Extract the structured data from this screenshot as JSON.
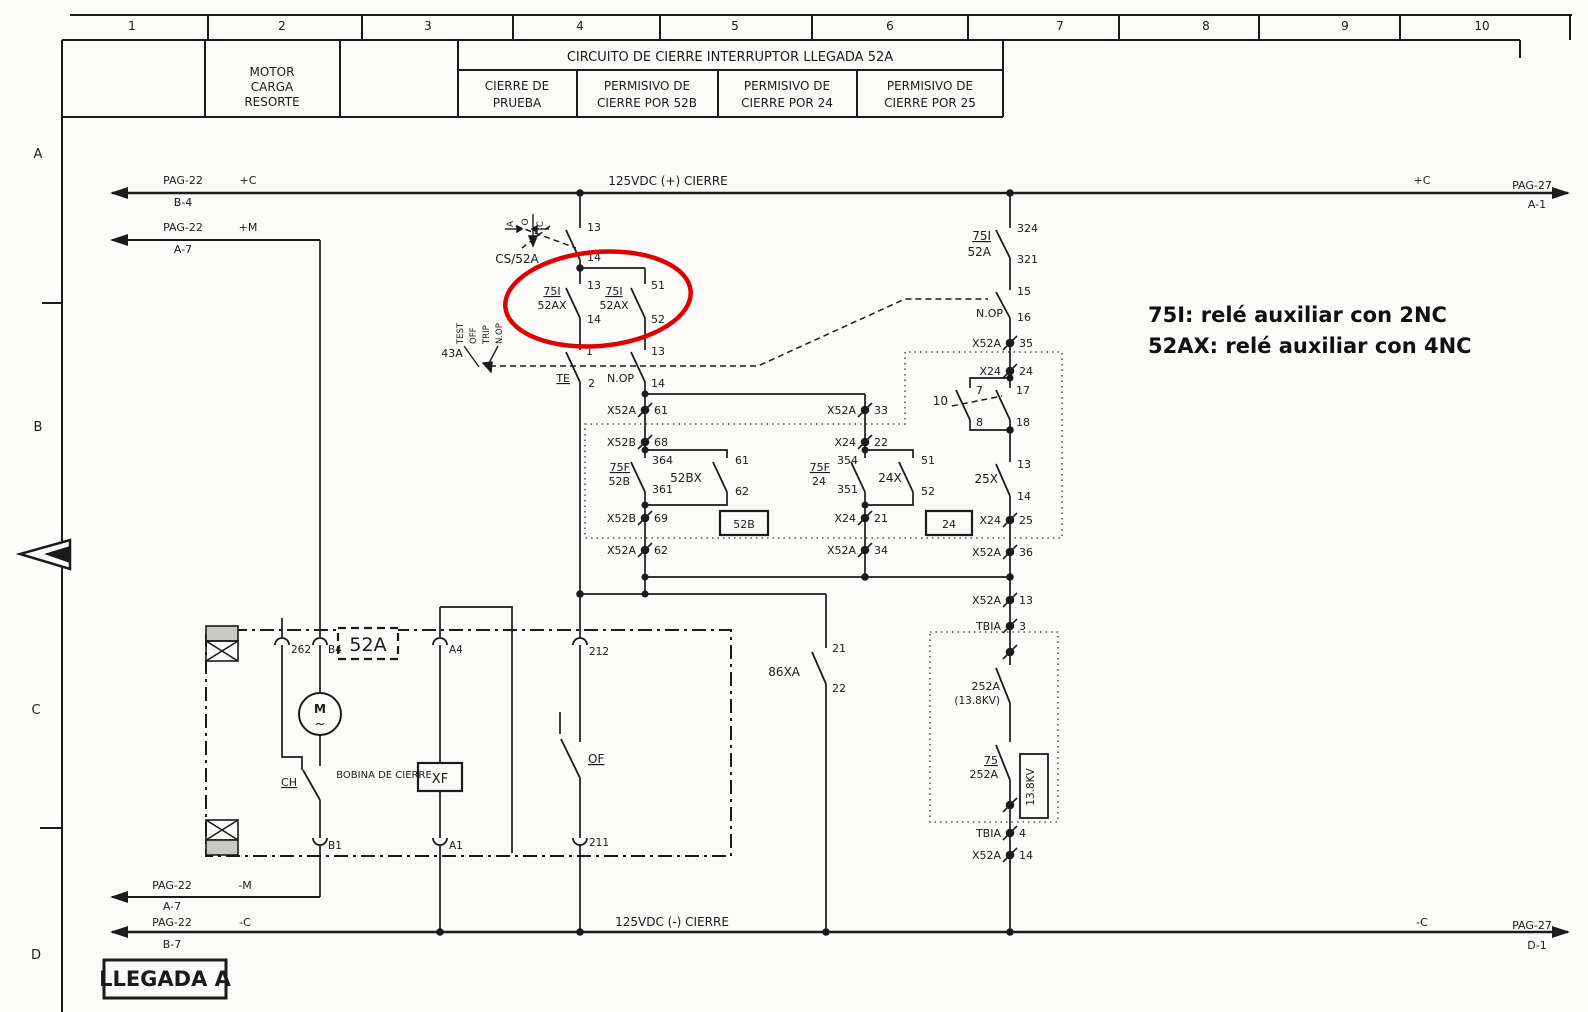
{
  "page": {
    "bg": "#fbfbf9",
    "ink": "#1b1b1b",
    "highlight_red": "#e10000"
  },
  "meta": {
    "drawing_title": "CIRCUITO DE CIERRE INTERRUPTOR LLEGADA 52A",
    "sheet_label": "LLEGADA A",
    "bus_positive": "125VDC (+) CIERRE",
    "bus_negative": "125VDC (-) CIERRE"
  },
  "annotation": {
    "line1": "75I: relé auxiliar con 2NC",
    "line2": "52AX: relé auxiliar con 4NC"
  },
  "terminals": [
    {
      "x": 645,
      "y": 410,
      "p": "X52A",
      "pin": "61"
    },
    {
      "x": 645,
      "y": 442,
      "p": "X52B",
      "pin": "68"
    },
    {
      "x": 645,
      "y": 518,
      "p": "X52B",
      "pin": "69"
    },
    {
      "x": 645,
      "y": 550,
      "p": "X52A",
      "pin": "62"
    },
    {
      "x": 865,
      "y": 410,
      "p": "X52A",
      "pin": "33"
    },
    {
      "x": 865,
      "y": 442,
      "p": "X24",
      "pin": "22"
    },
    {
      "x": 865,
      "y": 518,
      "p": "X24",
      "pin": "21"
    },
    {
      "x": 865,
      "y": 550,
      "p": "X52A",
      "pin": "34"
    },
    {
      "x": 1010,
      "y": 343,
      "p": "X52A",
      "pin": "35"
    },
    {
      "x": 1010,
      "y": 371,
      "p": "X24",
      "pin": "24"
    },
    {
      "x": 1010,
      "y": 520,
      "p": "X24",
      "pin": "25"
    },
    {
      "x": 1010,
      "y": 552,
      "p": "X52A",
      "pin": "36"
    },
    {
      "x": 1010,
      "y": 600,
      "p": "X52A",
      "pin": "13"
    },
    {
      "x": 1010,
      "y": 626,
      "p": "TBIA",
      "pin": "3"
    },
    {
      "x": 1010,
      "y": 652,
      "p": "",
      "pin": ""
    },
    {
      "x": 1010,
      "y": 805,
      "p": "",
      "pin": ""
    },
    {
      "x": 1010,
      "y": 833,
      "p": "TBIA",
      "pin": "4"
    },
    {
      "x": 1010,
      "y": 855,
      "p": "X52A",
      "pin": "14"
    }
  ],
  "labels": [
    {
      "n": "grid-col-1",
      "t": "1",
      "x": 132,
      "y": 30,
      "s": 12,
      "a": "m"
    },
    {
      "n": "grid-col-2",
      "t": "2",
      "x": 282,
      "y": 30,
      "s": 12,
      "a": "m"
    },
    {
      "n": "grid-col-3",
      "t": "3",
      "x": 428,
      "y": 30,
      "s": 12,
      "a": "m"
    },
    {
      "n": "grid-col-4",
      "t": "4",
      "x": 580,
      "y": 30,
      "s": 12,
      "a": "m"
    },
    {
      "n": "grid-col-5",
      "t": "5",
      "x": 735,
      "y": 30,
      "s": 12,
      "a": "m"
    },
    {
      "n": "grid-col-6",
      "t": "6",
      "x": 890,
      "y": 30,
      "s": 12,
      "a": "m"
    },
    {
      "n": "grid-col-7",
      "t": "7",
      "x": 1060,
      "y": 30,
      "s": 12,
      "a": "m"
    },
    {
      "n": "grid-col-8",
      "t": "8",
      "x": 1206,
      "y": 30,
      "s": 12,
      "a": "m"
    },
    {
      "n": "grid-col-9",
      "t": "9",
      "x": 1345,
      "y": 30,
      "s": 12,
      "a": "m"
    },
    {
      "n": "grid-col-10",
      "t": "10",
      "x": 1482,
      "y": 30,
      "s": 12,
      "a": "m"
    },
    {
      "n": "grid-row-a",
      "t": "A",
      "x": 38,
      "y": 158,
      "s": 13,
      "a": "m"
    },
    {
      "n": "grid-row-b",
      "t": "B",
      "x": 38,
      "y": 431,
      "s": 13,
      "a": "m"
    },
    {
      "n": "grid-row-c",
      "t": "C",
      "x": 36,
      "y": 714,
      "s": 13,
      "a": "m"
    },
    {
      "n": "grid-row-d",
      "t": "D",
      "x": 36,
      "y": 959,
      "s": 13,
      "a": "m"
    },
    {
      "n": "cell-motor-1",
      "t": "MOTOR",
      "x": 272,
      "y": 76,
      "s": 12,
      "a": "m"
    },
    {
      "n": "cell-motor-2",
      "t": "CARGA",
      "x": 272,
      "y": 91,
      "s": 12,
      "a": "m"
    },
    {
      "n": "cell-motor-3",
      "t": "RESORTE",
      "x": 272,
      "y": 106,
      "s": 12,
      "a": "m"
    },
    {
      "n": "title",
      "t": "CIRCUITO DE CIERRE INTERRUPTOR LLEGADA 52A",
      "x": 730,
      "y": 61,
      "s": 13,
      "a": "m"
    },
    {
      "n": "cell-prueba-1",
      "t": "CIERRE DE",
      "x": 517,
      "y": 90,
      "s": 12,
      "a": "m"
    },
    {
      "n": "cell-prueba-2",
      "t": "PRUEBA",
      "x": 517,
      "y": 107,
      "s": 12,
      "a": "m"
    },
    {
      "n": "cell-52b-1",
      "t": "PERMISIVO DE",
      "x": 647,
      "y": 90,
      "s": 12,
      "a": "m"
    },
    {
      "n": "cell-52b-2",
      "t": "CIERRE POR 52B",
      "x": 647,
      "y": 107,
      "s": 12,
      "a": "m"
    },
    {
      "n": "cell-24-1",
      "t": "PERMISIVO DE",
      "x": 787,
      "y": 90,
      "s": 12,
      "a": "m"
    },
    {
      "n": "cell-24-2",
      "t": "CIERRE POR 24",
      "x": 787,
      "y": 107,
      "s": 12,
      "a": "m"
    },
    {
      "n": "cell-25-1",
      "t": "PERMISIVO DE",
      "x": 930,
      "y": 90,
      "s": 12,
      "a": "m"
    },
    {
      "n": "cell-25-2",
      "t": "CIERRE POR 25",
      "x": 930,
      "y": 107,
      "s": 12,
      "a": "m"
    },
    {
      "n": "ref-pag22-b4-a",
      "t": "PAG-22",
      "x": 183,
      "y": 184,
      "a": "m"
    },
    {
      "n": "ref-pag22-b4-b",
      "t": "B-4",
      "x": 183,
      "y": 206,
      "a": "m"
    },
    {
      "n": "bus-plus-c",
      "t": "+C",
      "x": 248,
      "y": 184,
      "a": "m"
    },
    {
      "n": "ref-pag22-a7-a",
      "t": "PAG-22",
      "x": 183,
      "y": 231,
      "a": "m"
    },
    {
      "n": "ref-pag22-a7-b",
      "t": "A-7",
      "x": 183,
      "y": 253,
      "a": "m"
    },
    {
      "n": "bus-plus-m",
      "t": "+M",
      "x": 248,
      "y": 231,
      "a": "m"
    },
    {
      "n": "bus-pos-name",
      "t": "125VDC (+) CIERRE",
      "x": 668,
      "y": 185,
      "s": 12,
      "a": "m"
    },
    {
      "n": "bus-plus-c-right",
      "t": "+C",
      "x": 1422,
      "y": 184,
      "a": "m"
    },
    {
      "n": "ref-pag27-a1-a",
      "t": "PAG-27",
      "x": 1532,
      "y": 189,
      "a": "m"
    },
    {
      "n": "ref-pag27-a1-b",
      "t": "A-1",
      "x": 1537,
      "y": 208,
      "a": "m"
    },
    {
      "n": "ref-pag22-ma",
      "t": "PAG-22",
      "x": 172,
      "y": 889,
      "a": "m"
    },
    {
      "n": "ref-pag22-mb",
      "t": "A-7",
      "x": 172,
      "y": 910,
      "a": "m"
    },
    {
      "n": "bus-minus-m",
      "t": "-M",
      "x": 245,
      "y": 889,
      "a": "m"
    },
    {
      "n": "ref-pag22-ca",
      "t": "PAG-22",
      "x": 172,
      "y": 926,
      "a": "m"
    },
    {
      "n": "ref-pag22-cb",
      "t": "B-7",
      "x": 172,
      "y": 948,
      "a": "m"
    },
    {
      "n": "bus-minus-c",
      "t": "-C",
      "x": 245,
      "y": 926,
      "a": "m"
    },
    {
      "n": "bus-neg-name",
      "t": "125VDC (-) CIERRE",
      "x": 672,
      "y": 926,
      "s": 12,
      "a": "m"
    },
    {
      "n": "bus-minus-c-right",
      "t": "-C",
      "x": 1422,
      "y": 926,
      "a": "m"
    },
    {
      "n": "ref-pag27-d1-a",
      "t": "PAG-27",
      "x": 1532,
      "y": 929,
      "a": "m"
    },
    {
      "n": "ref-pag27-d1-b",
      "t": "D-1",
      "x": 1537,
      "y": 949,
      "a": "m"
    },
    {
      "n": "sheet-name",
      "t": "LLEGADA A",
      "x": 165,
      "y": 986,
      "s": 21,
      "a": "m",
      "b": true
    },
    {
      "n": "switch-cs52a",
      "t": "CS/52A",
      "x": 517,
      "y": 263,
      "s": 12,
      "a": "m"
    },
    {
      "n": "cs-pos-a",
      "t": "A",
      "x": 513,
      "y": 224,
      "s": 9,
      "a": "m",
      "r": -90
    },
    {
      "n": "cs-pos-o",
      "t": "O",
      "x": 528,
      "y": 222,
      "s": 9,
      "a": "m",
      "r": -90
    },
    {
      "n": "cs-pos-c",
      "t": "C",
      "x": 543,
      "y": 224,
      "s": 9,
      "a": "m",
      "r": -90
    },
    {
      "n": "pin-cs-13",
      "t": "13",
      "x": 587,
      "y": 231
    },
    {
      "n": "pin-cs-14",
      "t": "14",
      "x": 587,
      "y": 261
    },
    {
      "n": "relay-75i-1a",
      "t": "75I",
      "x": 552,
      "y": 295,
      "a": "m",
      "u": true
    },
    {
      "n": "relay-75i-1b",
      "t": "52AX",
      "x": 552,
      "y": 309,
      "a": "m"
    },
    {
      "n": "pin-75i1-13",
      "t": "13",
      "x": 587,
      "y": 289
    },
    {
      "n": "pin-75i1-14",
      "t": "14",
      "x": 587,
      "y": 323
    },
    {
      "n": "relay-75i-2a",
      "t": "75I",
      "x": 614,
      "y": 295,
      "a": "m",
      "u": true
    },
    {
      "n": "relay-75i-2b",
      "t": "52AX",
      "x": 614,
      "y": 309,
      "a": "m"
    },
    {
      "n": "pin-75i2-51",
      "t": "51",
      "x": 651,
      "y": 289
    },
    {
      "n": "pin-75i2-52",
      "t": "52",
      "x": 651,
      "y": 323
    },
    {
      "n": "switch-43a",
      "t": "43A",
      "x": 452,
      "y": 357,
      "a": "m"
    },
    {
      "n": "pos-test",
      "t": "TEST",
      "x": 463,
      "y": 344,
      "s": 8.5,
      "r": -90
    },
    {
      "n": "pos-off",
      "t": "OFF",
      "x": 476,
      "y": 344,
      "s": 8.5,
      "r": -90
    },
    {
      "n": "pos-trip",
      "t": "TRIP",
      "x": 489,
      "y": 344,
      "s": 8.5,
      "r": -90
    },
    {
      "n": "pos-nop",
      "t": "N.OP",
      "x": 502,
      "y": 344,
      "s": 8.5,
      "r": -90
    },
    {
      "n": "contact-te",
      "t": "TE",
      "x": 570,
      "y": 382,
      "a": "e",
      "u": true
    },
    {
      "n": "pin-te-1",
      "t": "1",
      "x": 586,
      "y": 355
    },
    {
      "n": "pin-te-2",
      "t": "2",
      "x": 588,
      "y": 387
    },
    {
      "n": "contact-nop-l",
      "t": "N.OP",
      "x": 634,
      "y": 382,
      "a": "e"
    },
    {
      "n": "pin-nop-13",
      "t": "13",
      "x": 651,
      "y": 355
    },
    {
      "n": "pin-nop-14",
      "t": "14",
      "x": 651,
      "y": 387
    },
    {
      "n": "pin-75f52b-364",
      "t": "364",
      "x": 652,
      "y": 464
    },
    {
      "n": "pin-75f52b-361",
      "t": "361",
      "x": 652,
      "y": 493
    },
    {
      "n": "relay-75f52b-a",
      "t": "75F",
      "x": 630,
      "y": 471,
      "a": "e",
      "u": true
    },
    {
      "n": "relay-75f52b-b",
      "t": "52B",
      "x": 630,
      "y": 485,
      "a": "e"
    },
    {
      "n": "pin-52bx-61",
      "t": "61",
      "x": 735,
      "y": 464
    },
    {
      "n": "pin-52bx-62",
      "t": "62",
      "x": 735,
      "y": 495
    },
    {
      "n": "relay-52bx",
      "t": "52BX",
      "x": 686,
      "y": 482,
      "s": 12,
      "a": "m"
    },
    {
      "n": "box-52b",
      "t": "52B",
      "x": 744,
      "y": 528,
      "a": "m"
    },
    {
      "n": "pin-75f24-354",
      "t": "354",
      "x": 858,
      "y": 464,
      "a": "e"
    },
    {
      "n": "pin-75f24-351",
      "t": "351",
      "x": 858,
      "y": 493,
      "a": "e"
    },
    {
      "n": "relay-75f24-a",
      "t": "75F",
      "x": 830,
      "y": 471,
      "a": "e",
      "u": true
    },
    {
      "n": "relay-75f24-b",
      "t": "24",
      "x": 826,
      "y": 485,
      "a": "e"
    },
    {
      "n": "pin-24x-51",
      "t": "51",
      "x": 921,
      "y": 464
    },
    {
      "n": "pin-24x-52",
      "t": "52",
      "x": 921,
      "y": 495
    },
    {
      "n": "relay-24x",
      "t": "24X",
      "x": 890,
      "y": 482,
      "s": 12,
      "a": "m"
    },
    {
      "n": "box-24",
      "t": "24",
      "x": 949,
      "y": 528,
      "a": "m"
    },
    {
      "n": "pin-75i52a-324",
      "t": "324",
      "x": 1017,
      "y": 232
    },
    {
      "n": "pin-75i52a-321",
      "t": "321",
      "x": 1017,
      "y": 263
    },
    {
      "n": "relay-75i52a-a",
      "t": "75I",
      "x": 991,
      "y": 240,
      "s": 12,
      "a": "e",
      "u": true
    },
    {
      "n": "relay-75i52a-b",
      "t": "52A",
      "x": 991,
      "y": 256,
      "s": 12,
      "a": "e"
    },
    {
      "n": "pin-nopr-15",
      "t": "15",
      "x": 1017,
      "y": 295
    },
    {
      "n": "contact-nop-r",
      "t": "N.OP",
      "x": 1003,
      "y": 317,
      "a": "e"
    },
    {
      "n": "pin-nopr-16",
      "t": "16",
      "x": 1017,
      "y": 321
    },
    {
      "n": "contact-10",
      "t": "10",
      "x": 948,
      "y": 405,
      "s": 12,
      "a": "e"
    },
    {
      "n": "pin-10-7",
      "t": "7",
      "x": 976,
      "y": 394
    },
    {
      "n": "pin-10-8",
      "t": "8",
      "x": 976,
      "y": 426
    },
    {
      "n": "pin-10-17",
      "t": "17",
      "x": 1016,
      "y": 394
    },
    {
      "n": "pin-10-18",
      "t": "18",
      "x": 1016,
      "y": 426
    },
    {
      "n": "pin-25x-13",
      "t": "13",
      "x": 1017,
      "y": 468
    },
    {
      "n": "relay-25x",
      "t": "25X",
      "x": 998,
      "y": 483,
      "s": 12,
      "a": "e"
    },
    {
      "n": "pin-25x-14",
      "t": "14",
      "x": 1017,
      "y": 500
    },
    {
      "n": "relay-252a-a",
      "t": "252A",
      "x": 1000,
      "y": 690,
      "a": "e"
    },
    {
      "n": "relay-252a-b",
      "t": "(13.8KV)",
      "x": 1000,
      "y": 704,
      "s": 10.5,
      "a": "e"
    },
    {
      "n": "relay-75252a-a",
      "t": "75",
      "x": 998,
      "y": 764,
      "a": "e",
      "u": true
    },
    {
      "n": "relay-75252a-b",
      "t": "252A",
      "x": 998,
      "y": 778,
      "a": "e"
    },
    {
      "n": "box-138kv",
      "t": "13.8KV",
      "x": 1034,
      "y": 787,
      "s": 10.5,
      "a": "m",
      "r": -90
    },
    {
      "n": "relay-86xa",
      "t": "86XA",
      "x": 800,
      "y": 676,
      "s": 12,
      "a": "e"
    },
    {
      "n": "pin-86xa-21",
      "t": "21",
      "x": 832,
      "y": 652
    },
    {
      "n": "pin-86xa-22",
      "t": "22",
      "x": 832,
      "y": 692
    },
    {
      "n": "box-52a",
      "t": "52A",
      "x": 368,
      "y": 651,
      "s": 19,
      "a": "m"
    },
    {
      "n": "plug-262",
      "t": "262",
      "x": 291,
      "y": 653,
      "s": 10.5
    },
    {
      "n": "plug-b4",
      "t": "B4",
      "x": 328,
      "y": 653,
      "s": 10.5
    },
    {
      "n": "plug-a4",
      "t": "A4",
      "x": 449,
      "y": 653,
      "s": 10.5
    },
    {
      "n": "plug-212",
      "t": "212",
      "x": 589,
      "y": 655,
      "s": 10.5
    },
    {
      "n": "plug-b1",
      "t": "B1",
      "x": 328,
      "y": 849,
      "s": 10.5
    },
    {
      "n": "plug-a1",
      "t": "A1",
      "x": 449,
      "y": 849,
      "s": 10.5
    },
    {
      "n": "plug-211",
      "t": "211",
      "x": 589,
      "y": 846,
      "s": 10.5
    },
    {
      "n": "motor-m",
      "t": "M",
      "x": 320,
      "y": 713,
      "s": 12,
      "a": "m",
      "b": true
    },
    {
      "n": "motor-tilde",
      "t": "~",
      "x": 320,
      "y": 728,
      "s": 13,
      "a": "m"
    },
    {
      "n": "contact-ch",
      "t": "CH",
      "x": 289,
      "y": 786,
      "a": "m",
      "u": true
    },
    {
      "n": "label-bobina",
      "t": "BOBINA DE CIERRE",
      "x": 384,
      "y": 778,
      "s": 10,
      "a": "m"
    },
    {
      "n": "coil-xf",
      "t": "XF",
      "x": 440,
      "y": 783,
      "s": 13,
      "a": "m"
    },
    {
      "n": "contact-of",
      "t": "OF",
      "x": 588,
      "y": 763,
      "s": 12,
      "u": true
    }
  ]
}
